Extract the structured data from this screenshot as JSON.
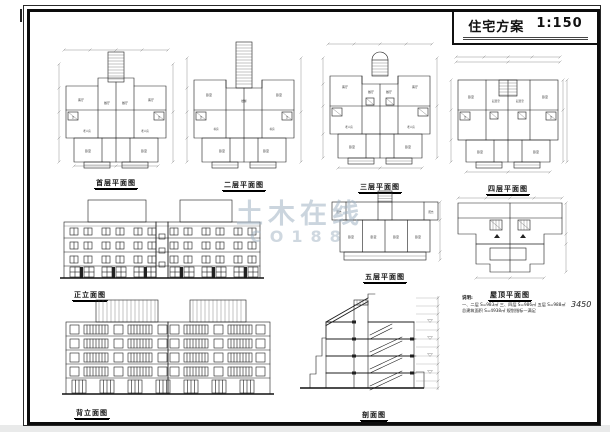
{
  "title_block": {
    "title": "住宅方案",
    "scale": "1:150"
  },
  "labels": {
    "plan1": "首层平面图",
    "plan2": "二层平面图",
    "plan3": "三层平面图",
    "plan4": "四层平面图",
    "plan5": "五层平面图",
    "roof": "屋顶平面图",
    "front": "正立面图",
    "rear": "背立面图",
    "section": "剖面图"
  },
  "rooms": {
    "living": "客厅",
    "dining": "餐厅",
    "bedroom": "卧室",
    "elder": "老人房",
    "bath": "卫",
    "sitting": "起居室",
    "study": "书房",
    "balcony": "阳台",
    "stair": "楼梯"
  },
  "notes": {
    "head": "说明:",
    "line1": "一、二层 S=983㎡ 三、四层 S=986㎡ 五层 S=988㎡",
    "line2": "总建筑面积 S=4938㎡ 规划指标—满足",
    "dim": "3450"
  },
  "watermark": {
    "line1": "土木在线",
    "line2": "co188"
  }
}
